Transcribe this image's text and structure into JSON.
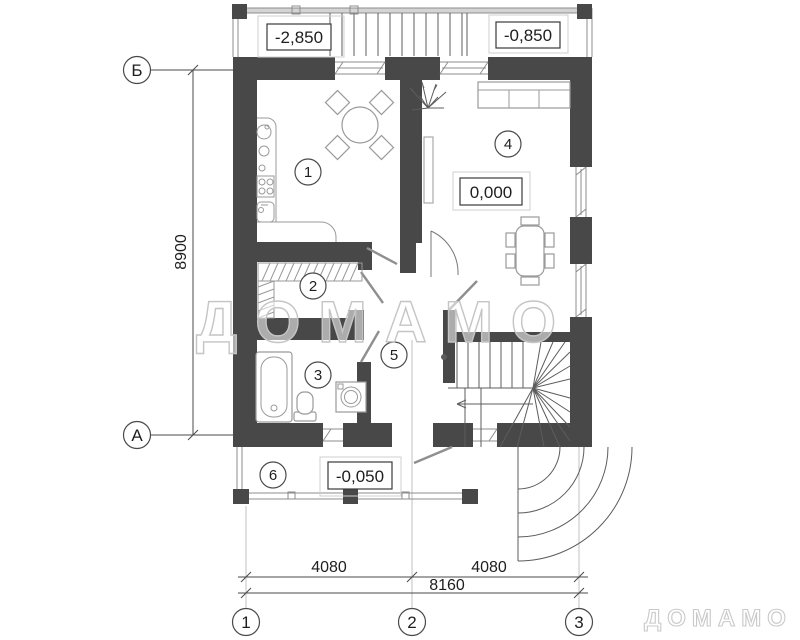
{
  "watermarks": {
    "plan_overlay": "ДОМАМО",
    "brand_logo": "ДОМАМО"
  },
  "axis_markers": {
    "left": [
      {
        "label": "Б"
      },
      {
        "label": "А"
      }
    ],
    "bottom": [
      {
        "label": "1"
      },
      {
        "label": "2"
      },
      {
        "label": "3"
      }
    ]
  },
  "dimensions": {
    "vertical_total": "8900",
    "bottom_left": "4080",
    "bottom_right": "4080",
    "bottom_total": "8160"
  },
  "elevation_marks": {
    "exterior_stair": "-2,850",
    "entry_landing": "-0,850",
    "ground_floor": "0,000",
    "terrace": "-0,050"
  },
  "room_numbers": [
    {
      "number": "1"
    },
    {
      "number": "2"
    },
    {
      "number": "3"
    },
    {
      "number": "4"
    },
    {
      "number": "5"
    },
    {
      "number": "6"
    }
  ],
  "colors": {
    "wall": "#484848",
    "dim_line": "#4a4a4a",
    "extension_line": "#c2c2c2",
    "watermark": "#c5c5c5"
  }
}
